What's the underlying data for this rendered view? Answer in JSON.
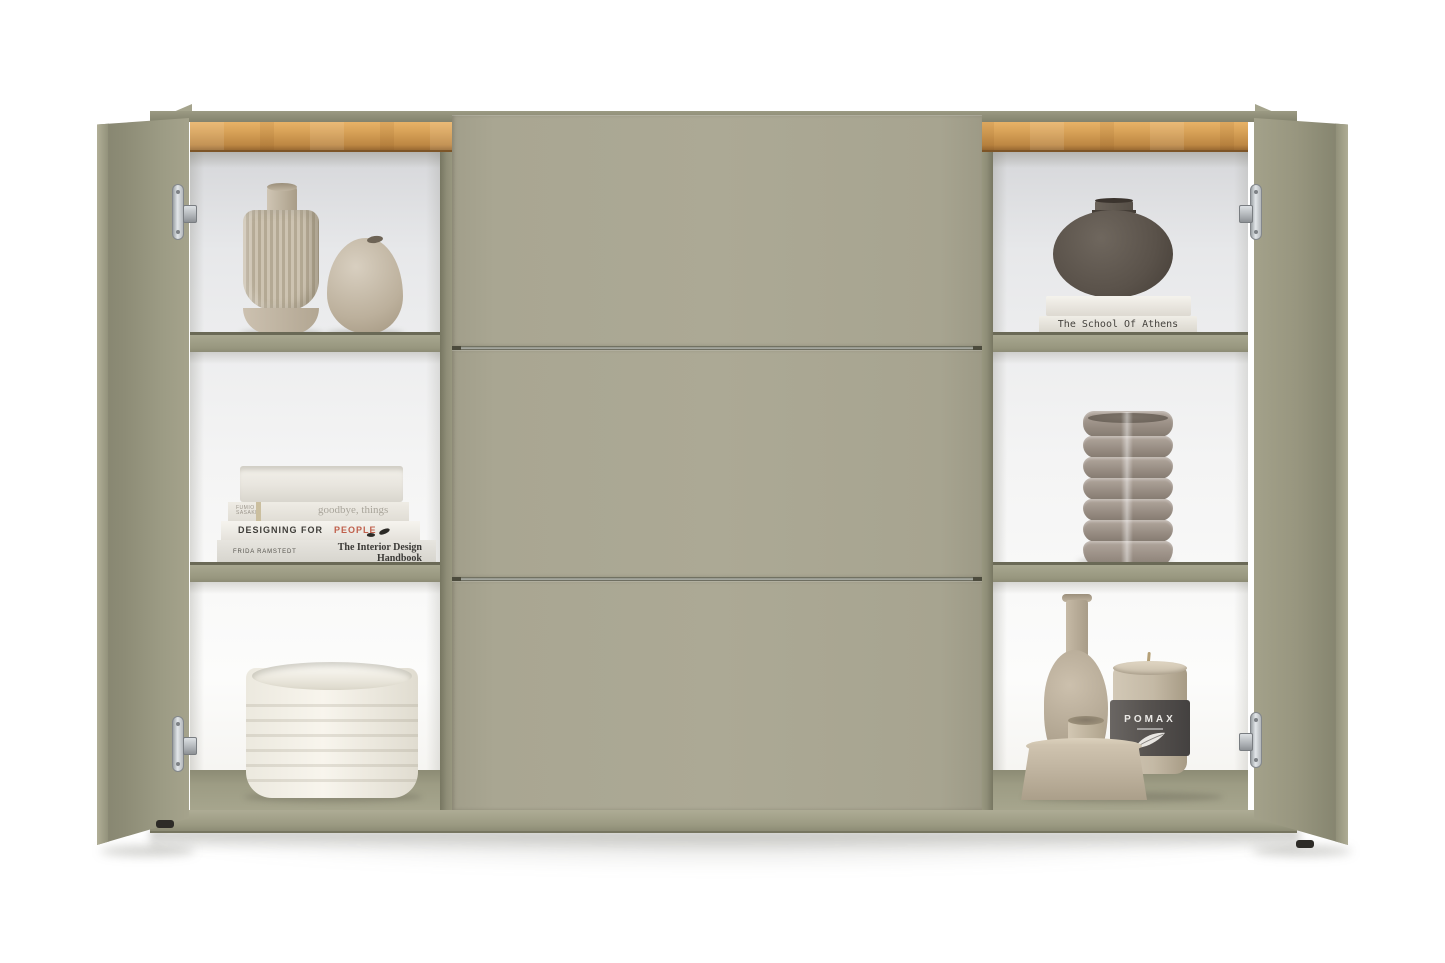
{
  "meta": {
    "scene": "Olive-green sideboard with oak trim, two open side doors and three closed center flaps, styled with ceramics, books and a candle"
  },
  "palette": {
    "background": "#ffffff",
    "door_olive": "#99977f",
    "flap_olive": "#a9a692",
    "divider_olive": "#84836e",
    "oak_trim": "#d59f55",
    "interior_white": "#f2f3f4",
    "shelf_edge": "#9d9c85",
    "base_band": "#a3a18a",
    "hinge_chrome": "#ccd0d4",
    "dark_vase": "#5a524a",
    "beige_ceramic": "#c3b8a5",
    "taupe_bowls": "#998e84",
    "white_bowl": "#f3f0e8",
    "candle_band": "#575350",
    "book_red_accent": "#c0604c"
  },
  "texts": {
    "book_goodbye_author": "FUMIO\nSASAKI",
    "book_goodbye_title": "goodbye, things",
    "book_designing_black": "DESIGNING FOR ",
    "book_designing_red": "PEOPLE",
    "book_handbook_author": "FRIDA RAMSTEDT",
    "book_handbook_title": "The Interior Design\nHandbook",
    "book_athens_title": "The School Of Athens",
    "candle_brand": "POMAX"
  }
}
